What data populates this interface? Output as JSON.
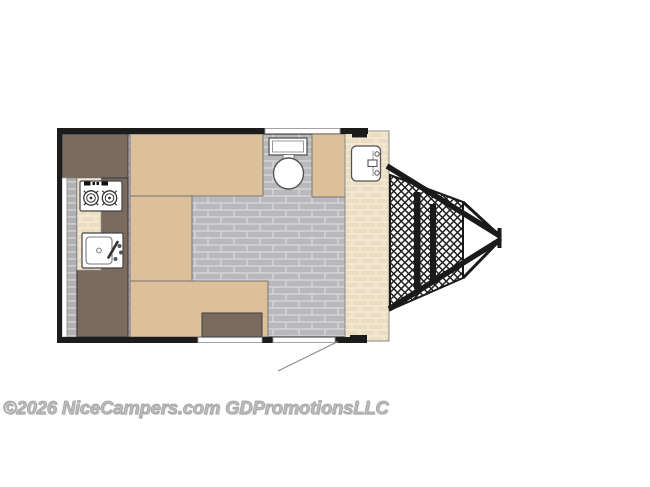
{
  "watermark": {
    "text": "©2026 NiceCampers.com GDPromotionsLLC"
  },
  "colors": {
    "tan": "#dcc099",
    "brown": "#7b6b5e",
    "wall": "#1c1c1c",
    "floor_brick": "#b9b9bc",
    "floor_grout": "#d6d6d8",
    "cream_brick": "#ebdec2",
    "cream_grout": "#f8f2e2",
    "mesh_line": "#1f1f1f",
    "fixture_white": "#ffffff",
    "door_swing_gray": "#8c8c8c",
    "watermark_gray": "#bdbdbd"
  },
  "floorplan": {
    "type": "camper-travel-trailer-floor-plan",
    "elements": [
      "wardrobe-cabinet",
      "two-burner-cooktop",
      "kitchen-sink",
      "galley-counter",
      "left-side-window",
      "dinette-bench-top",
      "dinette-bench-left",
      "dinette-bench-bottom",
      "table",
      "toilet",
      "bathroom-sink",
      "entry-landing",
      "rear-window",
      "front-window",
      "entry-door-opening",
      "door-swing",
      "a-frame-tongue",
      "mesh-rock-guard",
      "tongue-coupler"
    ]
  }
}
